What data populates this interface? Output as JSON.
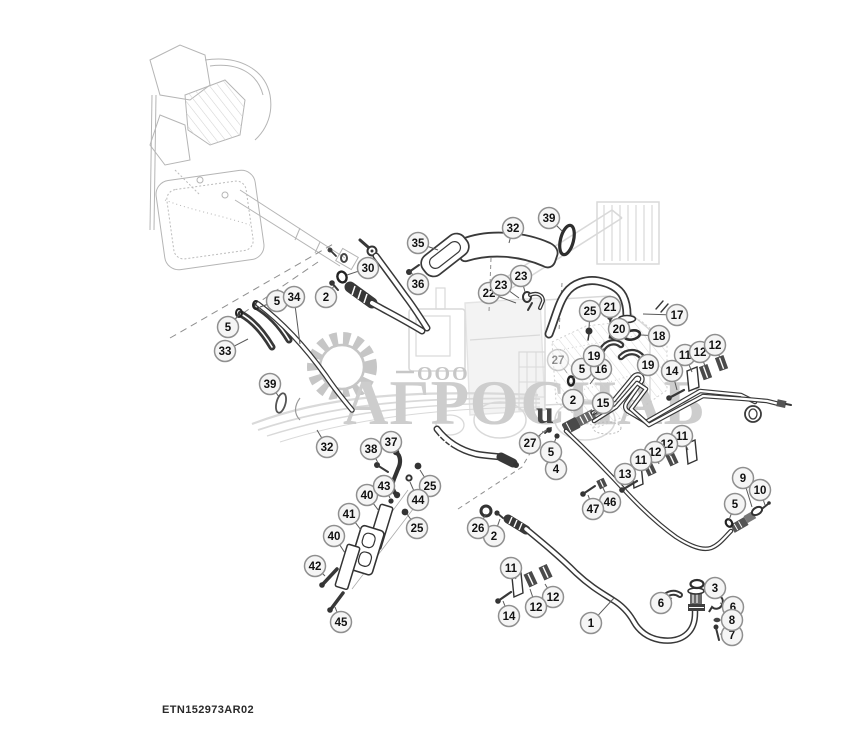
{
  "drawing_id": "ETN152973AR02",
  "watermark": {
    "ooo": "ООО",
    "company": "АГРОСНАБ",
    "stray_letter": "u",
    "color": "#cdcdcd"
  },
  "style": {
    "line": "#383838",
    "leader": "#5a5a5a",
    "callout_fill": "#f5f5f5",
    "callout_stroke": "#8f8f8f",
    "callout_text": "#111111",
    "callout_radius": 10.5
  },
  "callouts": [
    {
      "n": "1",
      "x": 591,
      "y": 623,
      "tx": 614,
      "ty": 598
    },
    {
      "n": "2",
      "x": 326,
      "y": 297,
      "tx": 334,
      "ty": 286
    },
    {
      "n": "2",
      "x": 573,
      "y": 400,
      "tx": 566,
      "ty": 396
    },
    {
      "n": "2",
      "x": 494,
      "y": 536,
      "tx": 500,
      "ty": 519
    },
    {
      "n": "3",
      "x": 715,
      "y": 588,
      "tx": 704,
      "ty": 586
    },
    {
      "n": "4",
      "x": 556,
      "y": 469,
      "tx": 549,
      "ty": 447
    },
    {
      "n": "5",
      "x": 228,
      "y": 327,
      "tx": 239,
      "ty": 315
    },
    {
      "n": "5",
      "x": 277,
      "y": 301,
      "tx": 260,
      "ty": 307
    },
    {
      "n": "5",
      "x": 582,
      "y": 369,
      "tx": 572,
      "ty": 379
    },
    {
      "n": "5",
      "x": 551,
      "y": 452,
      "tx": 556,
      "ty": 438
    },
    {
      "n": "5",
      "x": 735,
      "y": 504,
      "tx": 729,
      "ty": 520
    },
    {
      "n": "6",
      "x": 661,
      "y": 603,
      "tx": 672,
      "ty": 598
    },
    {
      "n": "6",
      "x": 733,
      "y": 607,
      "tx": 720,
      "ty": 603
    },
    {
      "n": "7",
      "x": 732,
      "y": 635,
      "tx": 720,
      "ty": 634
    },
    {
      "n": "8",
      "x": 732,
      "y": 620,
      "tx": 721,
      "ty": 620
    },
    {
      "n": "9",
      "x": 743,
      "y": 478,
      "tx": 752,
      "ty": 507
    },
    {
      "n": "10",
      "x": 760,
      "y": 490,
      "tx": 765,
      "ty": 505
    },
    {
      "n": "11",
      "x": 685,
      "y": 355,
      "tx": 692,
      "ty": 372
    },
    {
      "n": "12",
      "x": 700,
      "y": 352,
      "tx": 705,
      "ty": 366
    },
    {
      "n": "12",
      "x": 715,
      "y": 345,
      "tx": 720,
      "ty": 358
    },
    {
      "n": "14",
      "x": 672,
      "y": 371,
      "tx": 677,
      "ty": 390
    },
    {
      "n": "11",
      "x": 682,
      "y": 436,
      "tx": 688,
      "ty": 450
    },
    {
      "n": "12",
      "x": 667,
      "y": 444,
      "tx": 671,
      "ty": 456
    },
    {
      "n": "12",
      "x": 655,
      "y": 452,
      "tx": 659,
      "ty": 464
    },
    {
      "n": "11",
      "x": 641,
      "y": 460,
      "tx": 646,
      "ty": 470
    },
    {
      "n": "13",
      "x": 625,
      "y": 474,
      "tx": 630,
      "ty": 484
    },
    {
      "n": "46",
      "x": 610,
      "y": 502,
      "tx": 603,
      "ty": 488
    },
    {
      "n": "47",
      "x": 593,
      "y": 509,
      "tx": 588,
      "ty": 495
    },
    {
      "n": "15",
      "x": 603,
      "y": 403,
      "tx": 592,
      "ty": 415
    },
    {
      "n": "16",
      "x": 601,
      "y": 369,
      "tx": 590,
      "ty": 384
    },
    {
      "n": "17",
      "x": 677,
      "y": 315,
      "tx": 643,
      "ty": 314
    },
    {
      "n": "18",
      "x": 659,
      "y": 336,
      "tx": 641,
      "ty": 335
    },
    {
      "n": "19",
      "x": 594,
      "y": 356,
      "tx": 605,
      "ty": 348
    },
    {
      "n": "19",
      "x": 648,
      "y": 365,
      "tx": 639,
      "ty": 358
    },
    {
      "n": "20",
      "x": 619,
      "y": 329,
      "tx": 613,
      "ty": 334
    },
    {
      "n": "21",
      "x": 610,
      "y": 307,
      "tx": 610,
      "ty": 319
    },
    {
      "n": "22",
      "x": 489,
      "y": 293,
      "tx": 516,
      "ty": 303
    },
    {
      "n": "23",
      "x": 521,
      "y": 276,
      "tx": 525,
      "ty": 292
    },
    {
      "n": "23",
      "x": 501,
      "y": 285,
      "tx": 519,
      "ty": 298
    },
    {
      "n": "25",
      "x": 590,
      "y": 311,
      "tx": 589,
      "ty": 328
    },
    {
      "n": "25",
      "x": 430,
      "y": 486,
      "tx": 420,
      "ty": 470
    },
    {
      "n": "25",
      "x": 417,
      "y": 528,
      "tx": 407,
      "ty": 514
    },
    {
      "n": "26",
      "x": 478,
      "y": 528,
      "tx": 486,
      "ty": 514
    },
    {
      "n": "27",
      "x": 530,
      "y": 443,
      "tx": 546,
      "ty": 430
    },
    {
      "n": "27",
      "x": 558,
      "y": 360,
      "tx": 567,
      "ty": 373,
      "faded": true
    },
    {
      "n": "30",
      "x": 368,
      "y": 268,
      "tx": 347,
      "ty": 275
    },
    {
      "n": "32",
      "x": 513,
      "y": 228,
      "tx": 509,
      "ty": 243
    },
    {
      "n": "32",
      "x": 327,
      "y": 447,
      "tx": 317,
      "ty": 430
    },
    {
      "n": "33",
      "x": 225,
      "y": 351,
      "tx": 248,
      "ty": 339
    },
    {
      "n": "34",
      "x": 294,
      "y": 297,
      "tx": 300,
      "ty": 344
    },
    {
      "n": "35",
      "x": 418,
      "y": 243,
      "tx": 438,
      "ty": 250
    },
    {
      "n": "36",
      "x": 418,
      "y": 284,
      "tx": 411,
      "ty": 272
    },
    {
      "n": "37",
      "x": 391,
      "y": 442,
      "tx": 396,
      "ty": 453
    },
    {
      "n": "38",
      "x": 371,
      "y": 449,
      "tx": 378,
      "ty": 463
    },
    {
      "n": "39",
      "x": 549,
      "y": 218,
      "tx": 562,
      "ty": 231
    },
    {
      "n": "39",
      "x": 270,
      "y": 384,
      "tx": 279,
      "ty": 397
    },
    {
      "n": "40",
      "x": 367,
      "y": 495,
      "tx": 379,
      "ty": 511
    },
    {
      "n": "40",
      "x": 334,
      "y": 536,
      "tx": 345,
      "ty": 553
    },
    {
      "n": "41",
      "x": 349,
      "y": 514,
      "tx": 361,
      "ty": 530
    },
    {
      "n": "42",
      "x": 315,
      "y": 566,
      "tx": 325,
      "ty": 576
    },
    {
      "n": "43",
      "x": 384,
      "y": 486,
      "tx": 390,
      "ty": 498
    },
    {
      "n": "44",
      "x": 418,
      "y": 500,
      "tx": 410,
      "ty": 482
    },
    {
      "n": "45",
      "x": 341,
      "y": 622,
      "tx": 335,
      "ty": 607
    },
    {
      "n": "11",
      "x": 511,
      "y": 568,
      "tx": 516,
      "ty": 579
    },
    {
      "n": "12",
      "x": 553,
      "y": 597,
      "tx": 545,
      "ty": 584
    },
    {
      "n": "12",
      "x": 536,
      "y": 607,
      "tx": 530,
      "ty": 589
    },
    {
      "n": "14",
      "x": 509,
      "y": 616,
      "tx": 503,
      "ty": 601
    }
  ]
}
